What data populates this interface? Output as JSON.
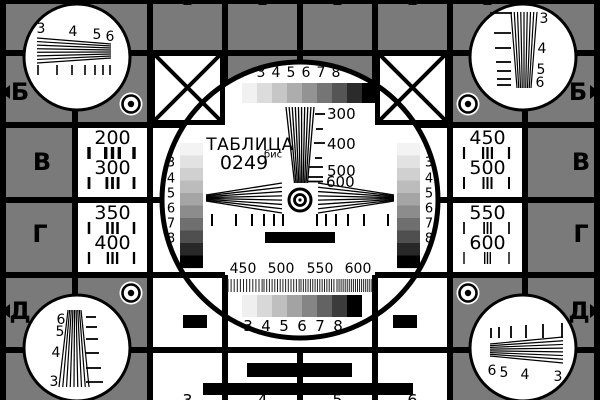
{
  "card": {
    "description": "television-test-pattern",
    "title": "ТАБЛИЦА",
    "code": "0249",
    "code_suffix": "бис",
    "colors": {
      "background": "#7a7a7a",
      "ink": "#000000",
      "panel": "#ffffff"
    },
    "row_letters": [
      "Б",
      "В",
      "Г",
      "Д"
    ],
    "left_cells": [
      {
        "values": [
          "200",
          "300"
        ]
      },
      {
        "values": [
          "350",
          "400"
        ]
      }
    ],
    "right_cells": [
      {
        "values": [
          "450",
          "500"
        ]
      },
      {
        "values": [
          "550",
          "600"
        ]
      }
    ],
    "center": {
      "gray_labels": [
        "3",
        "4",
        "5",
        "6",
        "7",
        "8"
      ],
      "top_steps": [
        "#f1f1f1",
        "#dcdcdc",
        "#c6c6c6",
        "#adadad",
        "#939393",
        "#757575",
        "#555555",
        "#2b2b2b",
        "#000000"
      ],
      "side_steps": [
        "#f3f3f3",
        "#e2e2e2",
        "#d0d0d0",
        "#bcbcbc",
        "#a5a5a5",
        "#8c8c8c",
        "#6f6f6f",
        "#4f4f4f",
        "#282828",
        "#000000"
      ],
      "bottom_steps": [
        "#efefef",
        "#d8d8d8",
        "#bfbfbf",
        "#a3a3a3",
        "#858585",
        "#636363",
        "#3b3b3b",
        "#000000"
      ],
      "wedge_labels": [
        "300",
        "400",
        "500",
        "600"
      ],
      "burst_labels": [
        "450",
        "500",
        "550",
        "600"
      ]
    },
    "corners": {
      "top_left_labels": [
        "3",
        "4",
        "5",
        "6"
      ],
      "top_right_labels": [
        "3",
        "4",
        "5",
        "6"
      ],
      "bottom_left_labels": [
        "6",
        "5",
        "4",
        "3"
      ],
      "bottom_right_labels": [
        "6",
        "5",
        "4",
        "3"
      ]
    },
    "bottom_edge_digits": [
      "3",
      "4",
      "5",
      "6"
    ]
  }
}
